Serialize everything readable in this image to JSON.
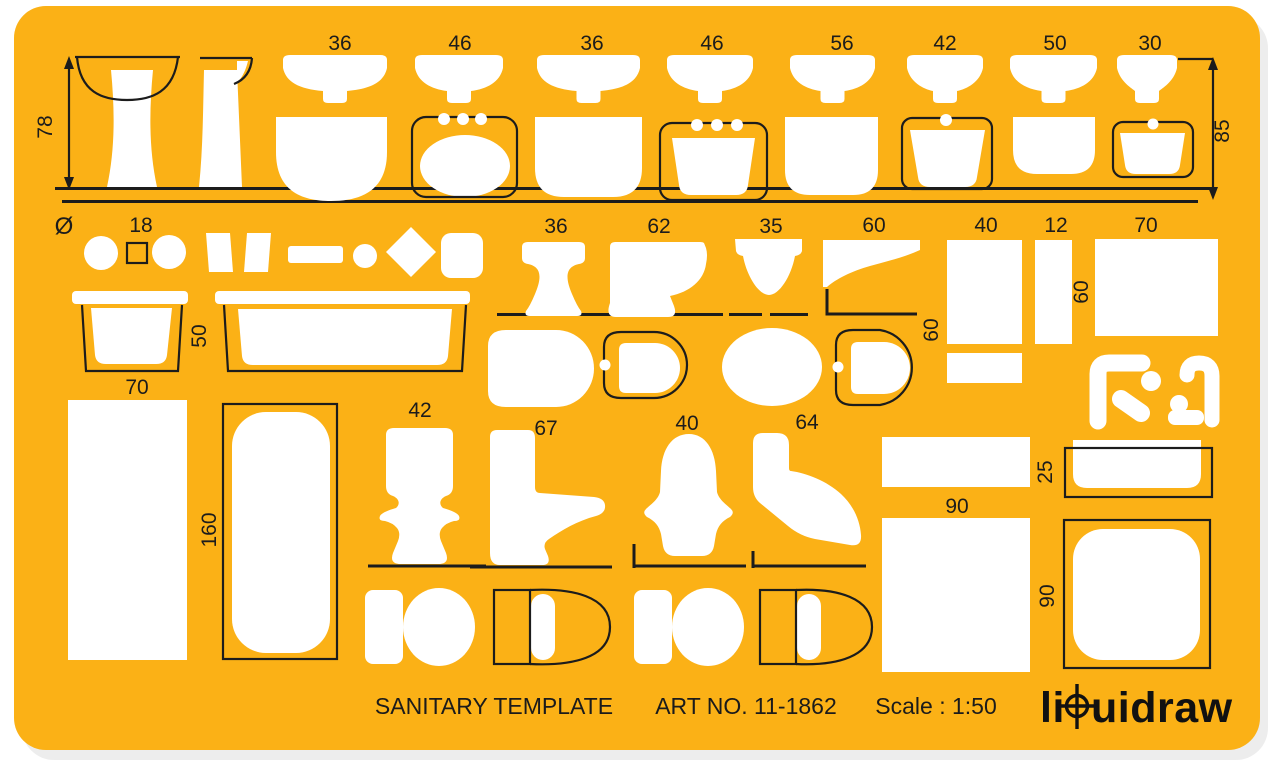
{
  "colors": {
    "body": "#FBB116",
    "line": "#1C1C1C",
    "cutout": "#FFFFFF",
    "background": "#FFFFFF"
  },
  "footer": {
    "title": "SANITARY TEMPLATE",
    "art_no": "ART NO. 11-1862",
    "scale": "Scale : 1:50"
  },
  "brand": {
    "full_name": "liquidraw",
    "name_prefix": "li",
    "name_suffix": "uidraw"
  },
  "dims": {
    "top": [
      "36",
      "46",
      "36",
      "46",
      "56",
      "42",
      "50",
      "30"
    ],
    "row2": [
      "36",
      "62",
      "35",
      "60",
      "40",
      "12",
      "70"
    ],
    "left_height": "78",
    "right_height": "85",
    "diameter_symbol": "Ø",
    "square_size": "18",
    "bath_width": "50",
    "bath_length": "70",
    "seat_depth": "60",
    "column_height": "60",
    "tub_length": "160",
    "wc_front_width": "42",
    "wc_side_length": "67",
    "bidet_front_width": "40",
    "bidet_side_length": "64",
    "tray_width": "90",
    "shelf_depth": "25",
    "tray_height": "90"
  }
}
